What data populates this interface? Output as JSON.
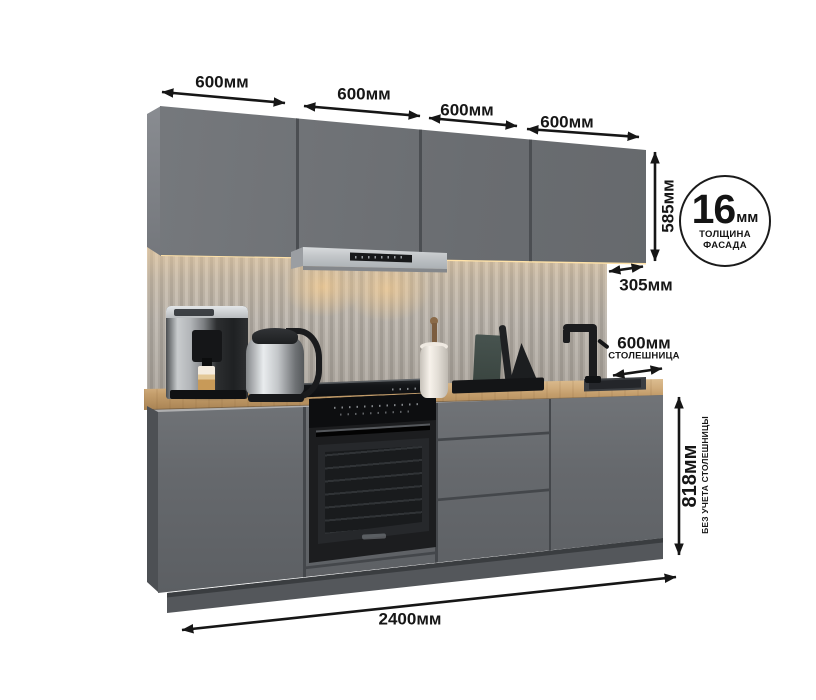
{
  "dimensions": {
    "wall_cabinet_widths": [
      "600мм",
      "600мм",
      "600мм",
      "600мм"
    ],
    "wall_cabinet_height": "585мм",
    "wall_cabinet_depth": "305мм",
    "countertop_depth": "600мм",
    "countertop_note": "СТОЛЕШНИЦА",
    "base_height": "818мм",
    "base_height_note": "БЕЗ УЧЕТА СТОЛЕШНИЦЫ",
    "total_width": "2400мм"
  },
  "badge": {
    "value": "16",
    "unit": "мм",
    "caption_line1": "ТОЛЩИНА",
    "caption_line2": "ФАСАДА"
  },
  "colors": {
    "dimension_ink": "#161616",
    "cabinet_front": "#6a6d71",
    "countertop_wood": "#c49e6c",
    "backsplash_panel": "#b3ada5",
    "hood_steel": "#c3c6c9",
    "oven_black": "#1c1d1f",
    "led_glow": "#ffe2a8",
    "background": "#ffffff"
  }
}
